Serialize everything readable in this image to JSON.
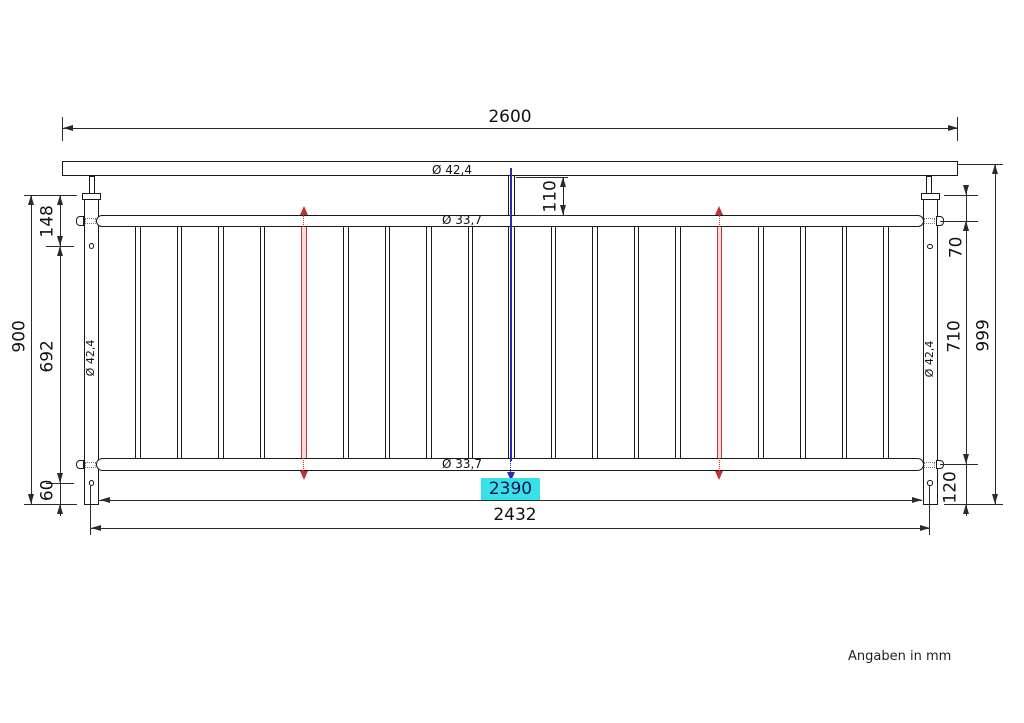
{
  "drawing": {
    "note": "Angaben in mm",
    "dims": {
      "overall_width": "2600",
      "handrail_dia": "Ø 42,4",
      "top_rail_dia": "Ø 33,7",
      "bottom_rail_dia": "Ø 33,7",
      "left_post_dia": "Ø 42,4",
      "right_post_dia": "Ø 42,4",
      "connector_length": "110",
      "post_top_to_upper_hole": "148",
      "upper_hole_to_lower_hole": "692",
      "post_height": "900",
      "lower_hole_to_post_bottom": "60",
      "post_top_to_top_rail": "70",
      "top_rail_to_bottom_rail": "710",
      "overall_height": "999",
      "bottom_rail_to_post_bottom": "120",
      "clear_span_between_posts": "2390",
      "post_center_to_center": "2432"
    },
    "railing": {
      "baluster_count": 19,
      "first_baluster_x": 138,
      "baluster_pitch": 41.55,
      "red_baluster_indices": [
        4,
        14
      ],
      "center_baluster_index": 9
    },
    "colors": {
      "line": "#1a1a1a",
      "dimension": "#2a2a2a",
      "marker_red": "#c23232",
      "marker_blue": "#2b2bb4",
      "highlight_cyan": "#38e1e9"
    }
  }
}
